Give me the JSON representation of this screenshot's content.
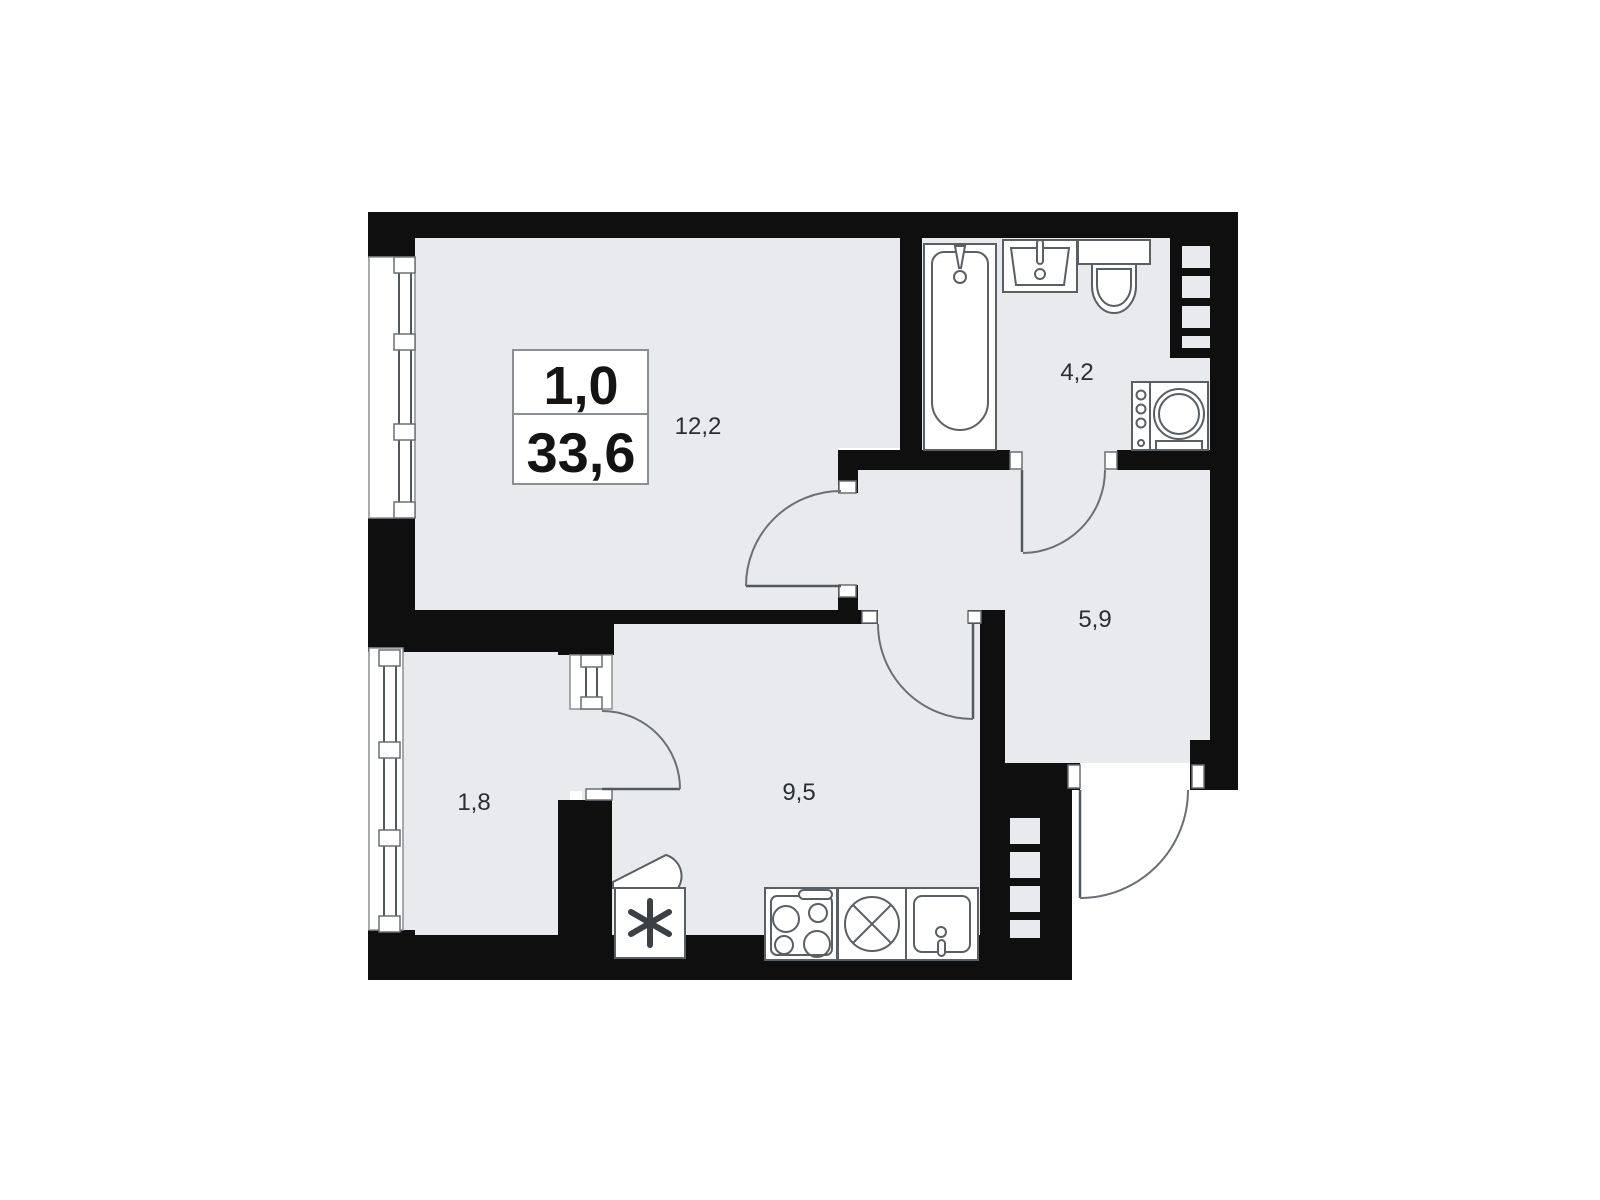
{
  "title_block": {
    "rooms_count": "1,0",
    "total_area": "33,6"
  },
  "room_labels": {
    "living": "12,2",
    "bathroom": "4,2",
    "hallway": "5,9",
    "kitchen": "9,5",
    "balcony": "1,8"
  },
  "fixtures": {
    "bathroom": [
      "bathtub",
      "washbasin",
      "toilet",
      "washing-machine"
    ],
    "kitchen": [
      "corner-counter",
      "fridge",
      "stove",
      "appliance-slot",
      "kitchen-sink"
    ]
  },
  "colors": {
    "wall": "#0f0f0f",
    "floor": "#e8eaee",
    "fixture_line": "#5a5f64",
    "label_text": "#2b2e31",
    "title_text": "#141414",
    "background": "#ffffff"
  }
}
